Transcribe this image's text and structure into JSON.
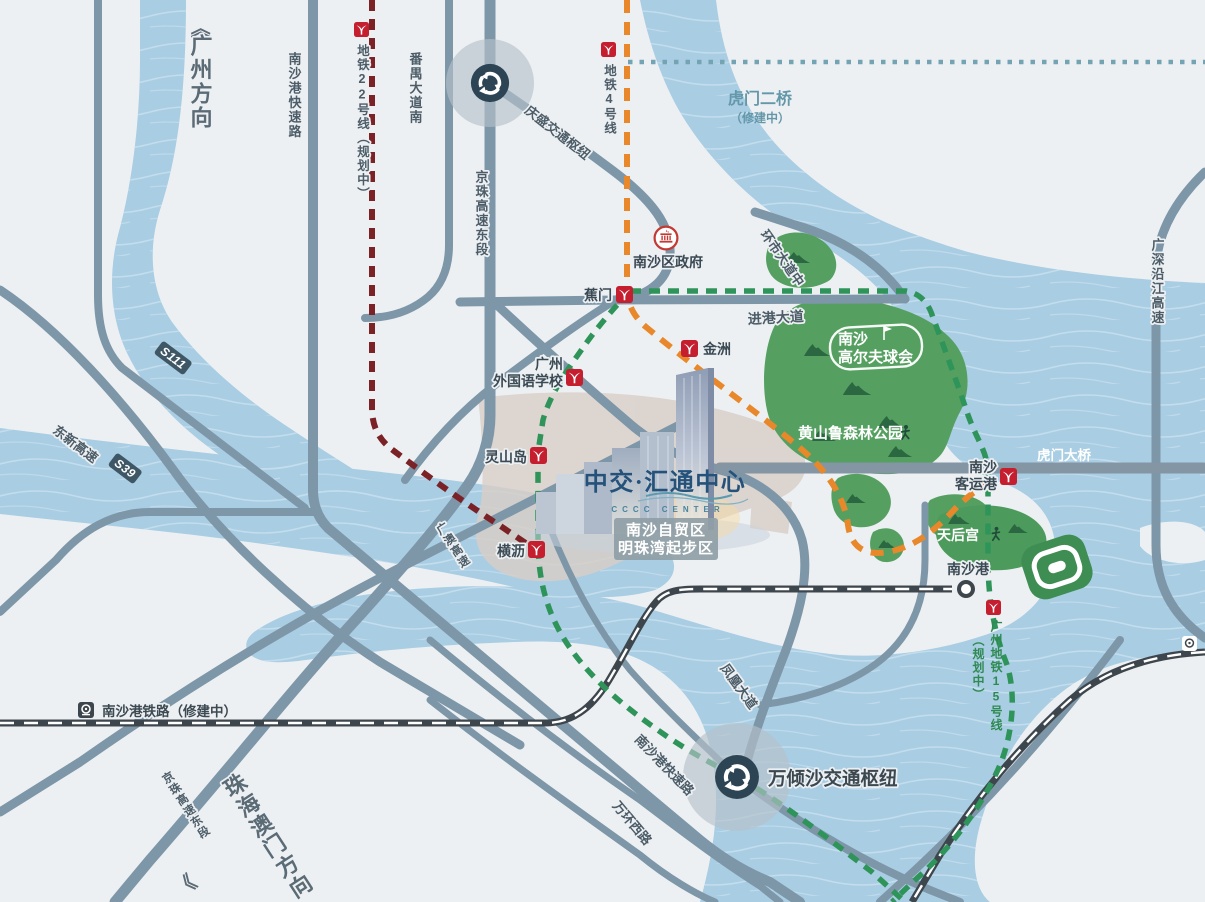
{
  "canvas": {
    "width": 1205,
    "height": 902
  },
  "colors": {
    "land": "#edf0f3",
    "water": "#a9cde3",
    "wave": "#c6dfee",
    "road": "#7d96a8",
    "bridge": "#8495a4",
    "railway": "#3e464d",
    "metro_line4": "#e8882b",
    "metro_line15": "#2f9459",
    "metro_line22": "#7b2227",
    "metro_logo_red": "#c41e2f",
    "park_green": "#55a061",
    "brand_blue": "#25527a",
    "tan_zone": "#d8cec5"
  },
  "directions": {
    "guangzhou": "广州方向",
    "guangzhou_chevron": "《",
    "zhuhai_macau": "珠海澳门方向",
    "zhuhai_chevron": "》"
  },
  "roads": {
    "nansha_port_expressway": "南沙港快速路",
    "panyu_avenue_south": "番禺大道南",
    "jingzhu_expressway_east": "京珠高速东段",
    "s111": "S111",
    "dongxin_expressway": "东新高速",
    "s39": "S39",
    "guangao_expressway": "广澳高速",
    "huanshi_avenue_middle": "环市大道中",
    "jingang_avenue": "进港大道",
    "humen_bridge": "虎门大桥",
    "humen_second_bridge": "虎门二桥",
    "humen_second_bridge_status": "（修建中）",
    "guangshen_yanjiang_expressway": "广深沿江高速",
    "fenghuang_avenue": "凤凰大道",
    "wanhuan_west_road": "万环西路"
  },
  "hubs": {
    "qingsheng": "庆盛交通枢纽",
    "wanqingsha": "万倾沙交通枢纽"
  },
  "railway": {
    "nansha_port_railway": "南沙港铁路（修建中）",
    "nansha_port_station": "南沙港"
  },
  "metro": {
    "line4_label": "地铁4号线",
    "line22_label": "地铁22号线（规划中）",
    "line15_label_name": "广州地铁15号线",
    "line15_label_status": "（规划中）",
    "stations": {
      "jiaomen": "蕉门",
      "jinzhou": "金洲",
      "gz_foreign_language_school_line1": "广州",
      "gz_foreign_language_school_line2": "外国语学校",
      "lingshandao": "灵山岛",
      "hengli": "横沥",
      "nansha_passenger_port_line1": "南沙",
      "nansha_passenger_port_line2": "客运港"
    }
  },
  "landmarks": {
    "nansha_district_government": "南沙区政府",
    "nansha_golf_club_line1": "南沙",
    "nansha_golf_club_line2": "高尔夫球会",
    "huangshanlu_forest_park": "黄山鲁森林公园",
    "tianhou_temple": "天后宫"
  },
  "project": {
    "name": "中交·汇通中心",
    "name_en": "CCCC CENTER",
    "zone_line1": "南沙自贸区",
    "zone_line2": "明珠湾起步区"
  }
}
